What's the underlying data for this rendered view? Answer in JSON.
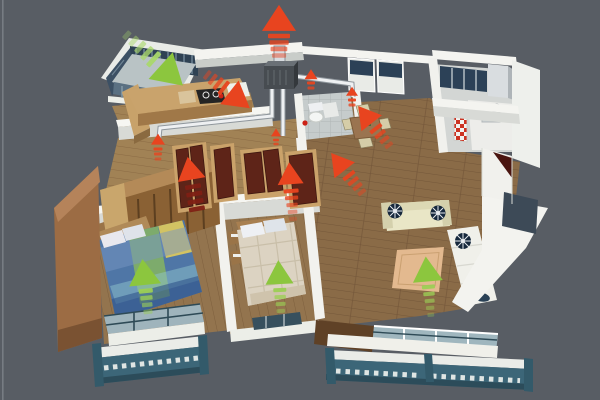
{
  "scene": {
    "background": "#585d64",
    "edge_highlight": "#82878e"
  },
  "palette": {
    "exhaust_red": "#e8441f",
    "exhaust_red_dark": "#7e2014",
    "fresh_green": "#8cc63e",
    "fresh_green_light": "#a9d86b",
    "wall_white": "#f4f4f0",
    "wall_shade": "#d8dad6",
    "wood_floor": "#8a6b47",
    "wood_floor_light": "#a98c60",
    "balcony_teal": "#3c6678",
    "door_mahogany": "#5e2418",
    "duct_white": "#eef0f2",
    "vent_unit_gray": "#474c51",
    "glass_blue": "#9fb6be",
    "window_navy": "#2c4157",
    "rug_tan": "#e3b98f"
  },
  "airflow": {
    "exhaust_arrows": [
      {
        "id": "roof-exhaust",
        "x": 279,
        "y": 20,
        "angle": 0,
        "width": 34,
        "height": 26,
        "trail": {
          "count": 4,
          "gap": 6.5,
          "dash_w": 22,
          "dash_h": 4.5,
          "shade": "normal",
          "fade": true,
          "start": 16
        }
      },
      {
        "id": "duct-branch-right",
        "x": 311,
        "y": 75,
        "angle": 0,
        "width": 13,
        "height": 10,
        "trail": {
          "count": 2,
          "gap": 5,
          "dash_w": 8,
          "dash_h": 3,
          "shade": "normal",
          "fade": true,
          "start": 8
        }
      },
      {
        "id": "duct-end-right",
        "x": 352,
        "y": 92,
        "angle": 0,
        "width": 12,
        "height": 9,
        "trail": {
          "count": 2,
          "gap": 5,
          "dash_w": 8,
          "dash_h": 3,
          "shade": "normal",
          "fade": true,
          "start": 8
        }
      },
      {
        "id": "duct-end-left",
        "x": 158,
        "y": 140,
        "angle": 0,
        "width": 14,
        "height": 11,
        "trail": {
          "count": 3,
          "gap": 5,
          "dash_w": 9,
          "dash_h": 3,
          "shade": "normal",
          "fade": true,
          "start": 9
        }
      },
      {
        "id": "kitchen-exhaust",
        "x": 238,
        "y": 99,
        "angle": 128,
        "width": 30,
        "height": 26,
        "trail": {
          "count": 4,
          "gap": 7,
          "dash_w": 16,
          "dash_h": 4,
          "shade": "normal",
          "fade": true,
          "start": 18
        }
      },
      {
        "id": "dining-exhaust-upper",
        "x": 366,
        "y": 116,
        "angle": -38,
        "width": 26,
        "height": 22,
        "trail": {
          "count": 4,
          "gap": 7,
          "dash_w": 14,
          "dash_h": 4,
          "shade": "normal",
          "fade": true,
          "start": 16
        }
      },
      {
        "id": "dining-exhaust-lower",
        "x": 339,
        "y": 163,
        "angle": -38,
        "width": 26,
        "height": 22,
        "trail": {
          "count": 4,
          "gap": 7,
          "dash_w": 14,
          "dash_h": 4,
          "shade": "normal",
          "fade": true,
          "start": 16
        }
      },
      {
        "id": "hall-exhaust-left",
        "x": 190,
        "y": 170,
        "angle": -10,
        "width": 28,
        "height": 23,
        "trail": {
          "count": 4,
          "gap": 7.5,
          "dash_w": 16,
          "dash_h": 4.5,
          "shade": "dark",
          "fade": false,
          "start": 17
        }
      },
      {
        "id": "hall-exhaust-center",
        "x": 290,
        "y": 175,
        "angle": -4,
        "width": 26,
        "height": 22,
        "trail": {
          "count": 5,
          "gap": 7,
          "dash_w": 15,
          "dash_h": 4,
          "shade": "normal",
          "fade": true,
          "start": 16
        }
      },
      {
        "id": "hall-grille",
        "x": 276,
        "y": 133,
        "angle": 0,
        "width": 10,
        "height": 8,
        "trail": {
          "count": 2,
          "gap": 4,
          "dash_w": 6,
          "dash_h": 2.5,
          "shade": "normal",
          "fade": true,
          "start": 7
        }
      }
    ],
    "fresh_air_arrows": [
      {
        "id": "fresh-intake-balcony",
        "x": 170,
        "y": 74,
        "angle": 132,
        "width": 36,
        "height": 30,
        "trail": {
          "count": 5,
          "gap": 9,
          "dash_w": 18,
          "dash_h": 5,
          "shade": "light",
          "fade": true,
          "start": 22
        }
      },
      {
        "id": "fresh-master-bedroom",
        "x": 144,
        "y": 274,
        "angle": -6,
        "width": 32,
        "height": 26,
        "trail": {
          "count": 4,
          "gap": 7,
          "dash_w": 14,
          "dash_h": 4.5,
          "shade": "green",
          "fade": true,
          "start": 17
        }
      },
      {
        "id": "fresh-second-bedroom",
        "x": 279,
        "y": 274,
        "angle": -3,
        "width": 28,
        "height": 24,
        "trail": {
          "count": 4,
          "gap": 7,
          "dash_w": 13,
          "dash_h": 4,
          "shade": "green",
          "fade": true,
          "start": 16
        }
      },
      {
        "id": "fresh-living-room",
        "x": 427,
        "y": 271,
        "angle": -5,
        "width": 30,
        "height": 25,
        "trail": {
          "count": 5,
          "gap": 7,
          "dash_w": 13,
          "dash_h": 4,
          "shade": "green",
          "fade": true,
          "start": 16
        }
      }
    ]
  }
}
